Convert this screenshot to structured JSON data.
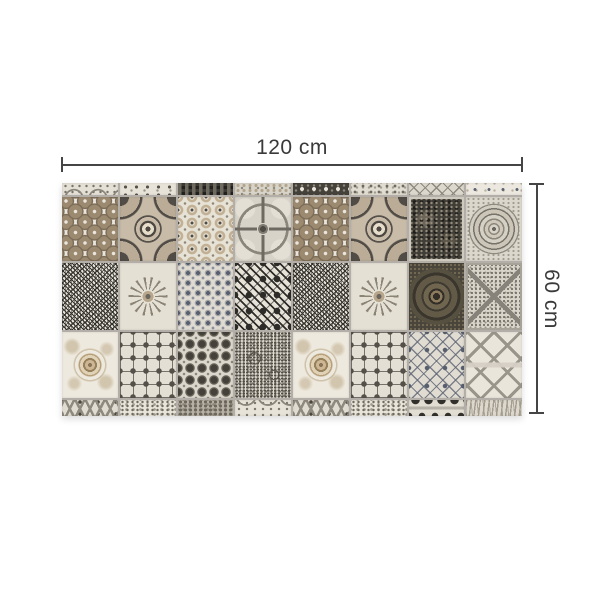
{
  "page": {
    "background_color": "#ffffff",
    "description": "Product dimension diagram of a patchwork vintage-tile panel"
  },
  "dimensions": {
    "width_label": "120 cm",
    "height_label": "60 cm",
    "line_color": "#454545",
    "text_color": "#3a3a3a"
  },
  "panel": {
    "grout_color": "#b3afa8",
    "columns": 8,
    "rows": [
      {
        "kind": "partial-top",
        "height": 12,
        "cells": [
          "garland",
          "sprigs",
          "checker",
          "mottle",
          "darkflower",
          "ornate",
          "lattice",
          "cream"
        ]
      },
      {
        "kind": "full",
        "height": 64,
        "cells": [
          "penny-medallions",
          "concave-square",
          "floral-lattice",
          "compass-circle",
          "penny-medallions",
          "concave-square",
          "dark-baroque",
          "plate-medallion"
        ]
      },
      {
        "kind": "full",
        "height": 67,
        "cells": [
          "scribble-maze",
          "floral-swirl",
          "damask-small",
          "arrow-hatch",
          "scribble-maze",
          "floral-swirl",
          "dark-rosette",
          "speckle-cross"
        ]
      },
      {
        "kind": "full",
        "height": 66,
        "cells": [
          "baroque-scroll",
          "square-frames",
          "cross-floral-dark",
          "paisley-speckle",
          "baroque-scroll",
          "square-frames",
          "damask-lattice",
          "quatrefoil-trellis"
        ]
      },
      {
        "kind": "partial-bottom",
        "height": 16,
        "cells": [
          "chevron",
          "speckle-light",
          "mottle-dark",
          "arcs",
          "chevron",
          "speckle-light",
          "crowns",
          "grain"
        ]
      }
    ],
    "palette": {
      "cream": "#e9e5dc",
      "tan_brown": "#9b8970",
      "charcoal": "#413e38",
      "mid_gray": "#8a867c",
      "blue_gray": "#59606f"
    }
  }
}
